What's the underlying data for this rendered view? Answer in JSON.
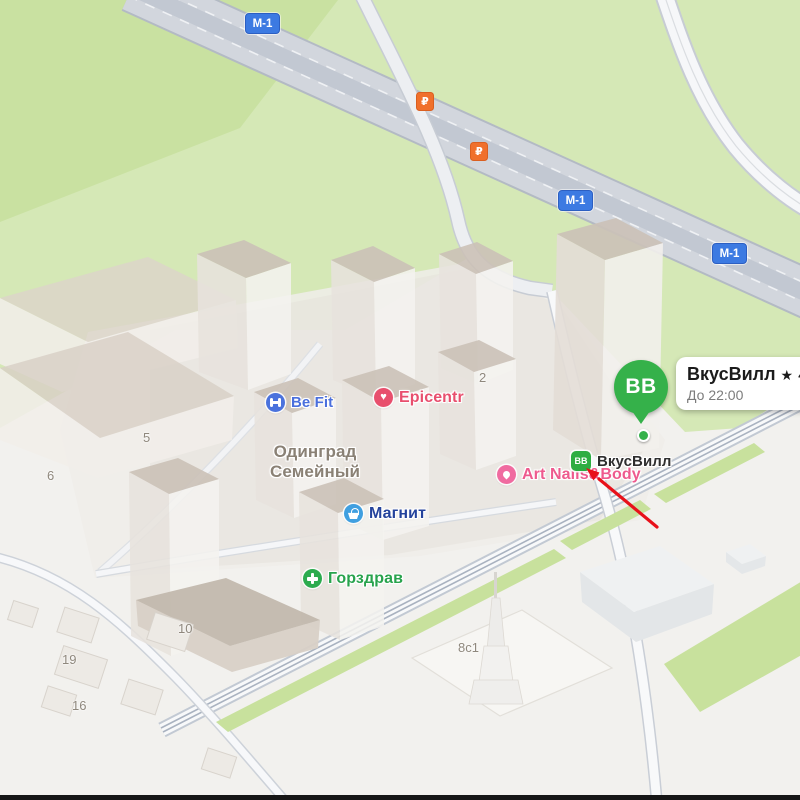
{
  "map": {
    "marker": {
      "label": "BB",
      "color": "#35b14a"
    },
    "card": {
      "title": "ВкусВилл",
      "star": "★",
      "rating": "4,6",
      "hours": "До 22:00"
    },
    "route_badges": [
      {
        "label": "М-1",
        "x": 245,
        "y": 13
      },
      {
        "label": "М-1",
        "x": 558,
        "y": 190
      },
      {
        "label": "М-1",
        "x": 712,
        "y": 243
      }
    ],
    "toll_signs": [
      {
        "label": "₽",
        "x": 416,
        "y": 92
      },
      {
        "label": "₽",
        "x": 470,
        "y": 142
      }
    ],
    "pois": [
      {
        "id": "befit",
        "label": "Be Fit",
        "icon": "dumbbell",
        "icon_bg": "#4a72dd",
        "label_color": "#4a6fdd",
        "label_px": 15,
        "label_weight": 600,
        "x": 266,
        "y": 393
      },
      {
        "id": "epicentr",
        "label": "Epicentr",
        "icon": "heart",
        "icon_bg": "#e84f6d",
        "label_color": "#e84f6e",
        "label_px": 16,
        "label_weight": 700,
        "x": 374,
        "y": 388
      },
      {
        "id": "odingrad-semeyny",
        "label": "Одинград\nСемейный",
        "icon": "none",
        "icon_bg": "",
        "label_color": "#8a8175",
        "label_px": 17,
        "label_weight": 600,
        "x": 270,
        "y": 442
      },
      {
        "id": "magnit",
        "label": "Магнит",
        "icon": "basket",
        "icon_bg": "#3f9fe0",
        "label_color": "#24439c",
        "label_px": 16,
        "label_weight": 700,
        "x": 344,
        "y": 504
      },
      {
        "id": "art-nails-body",
        "label": "Art Nails&Body",
        "icon": "lotus",
        "icon_bg": "#f06ba0",
        "label_color": "#ee5a8e",
        "label_px": 16,
        "label_weight": 600,
        "x": 497,
        "y": 465
      },
      {
        "id": "gorzdrav",
        "label": "Горздрав",
        "icon": "cross",
        "icon_bg": "#2cab4e",
        "label_color": "#28a34d",
        "label_px": 16,
        "label_weight": 700,
        "x": 303,
        "y": 569
      },
      {
        "id": "vkusvill",
        "label": "ВкусВилл",
        "icon": "bb",
        "icon_bg": "#2ead42",
        "icon_text": "ВВ",
        "label_color": "#2e2e2e",
        "label_px": 15,
        "label_weight": 600,
        "x": 571,
        "y": 451
      }
    ],
    "building_numbers": [
      {
        "label": "5",
        "x": 143,
        "y": 430
      },
      {
        "label": "6",
        "x": 47,
        "y": 468
      },
      {
        "label": "2",
        "x": 479,
        "y": 370
      },
      {
        "label": "10",
        "x": 178,
        "y": 621
      },
      {
        "label": "19",
        "x": 62,
        "y": 652
      },
      {
        "label": "16",
        "x": 72,
        "y": 698
      },
      {
        "label": "8с1",
        "x": 458,
        "y": 640
      }
    ]
  }
}
